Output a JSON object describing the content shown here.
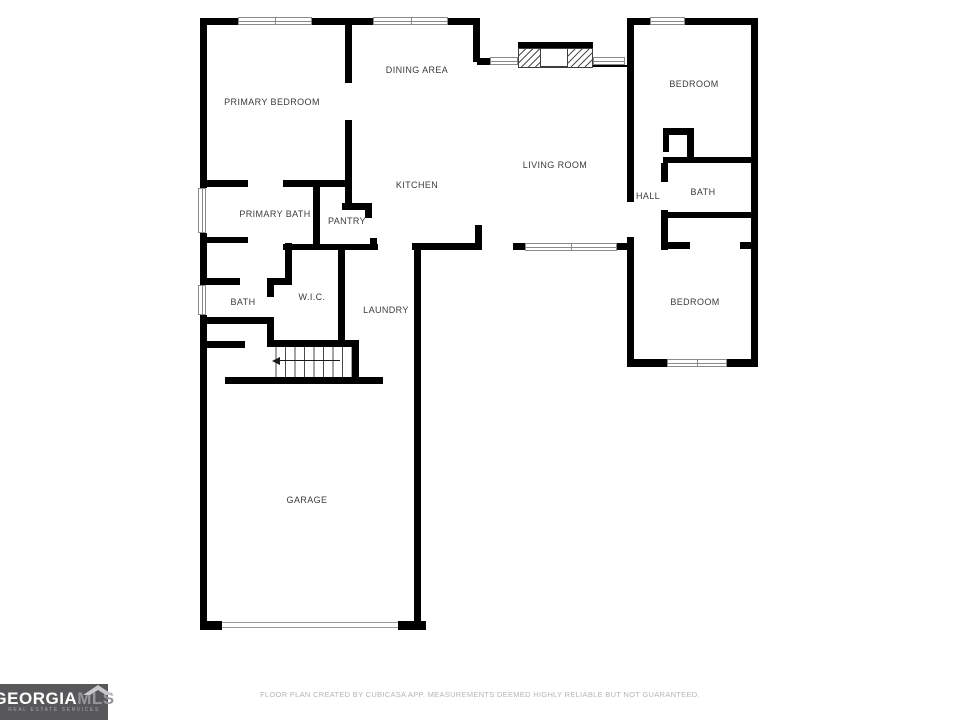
{
  "footer": {
    "disclaimer": "FLOOR PLAN CREATED BY CUBICASA APP. MEASUREMENTS DEEMED HIGHLY RELIABLE BUT NOT GUARANTEED."
  },
  "logo": {
    "brand_part1": "GEORGIA",
    "brand_part2": "MLS",
    "tagline": "REAL ESTATE SERVICES"
  },
  "floorplan": {
    "colors": {
      "wall": "#000000",
      "window_line": "#8a8a8a",
      "label": "#3b3b3b",
      "footer_text": "#b5b5b5",
      "logo_bg": "#58585a"
    },
    "rooms": [
      {
        "id": "primary-bedroom",
        "label": "PRIMARY BEDROOM",
        "cx": 272,
        "cy": 102
      },
      {
        "id": "dining-area",
        "label": "DINING AREA",
        "cx": 417,
        "cy": 70
      },
      {
        "id": "bedroom-top",
        "label": "BEDROOM",
        "cx": 694,
        "cy": 84
      },
      {
        "id": "living-room",
        "label": "LIVING ROOM",
        "cx": 555,
        "cy": 165
      },
      {
        "id": "kitchen",
        "label": "KITCHEN",
        "cx": 417,
        "cy": 185
      },
      {
        "id": "hall",
        "label": "HALL",
        "cx": 648,
        "cy": 196
      },
      {
        "id": "bath-right",
        "label": "BATH",
        "cx": 703,
        "cy": 192
      },
      {
        "id": "primary-bath",
        "label": "PRIMARY BATH",
        "cx": 275,
        "cy": 214
      },
      {
        "id": "pantry",
        "label": "PANTRY",
        "cx": 347,
        "cy": 221
      },
      {
        "id": "bath-left",
        "label": "BATH",
        "cx": 243,
        "cy": 302
      },
      {
        "id": "wic",
        "label": "W.I.C.",
        "cx": 312,
        "cy": 297
      },
      {
        "id": "laundry",
        "label": "LAUNDRY",
        "cx": 386,
        "cy": 310
      },
      {
        "id": "bedroom-bottom",
        "label": "BEDROOM",
        "cx": 695,
        "cy": 302
      },
      {
        "id": "garage",
        "label": "GARAGE",
        "cx": 307,
        "cy": 500
      }
    ],
    "walls": [
      [
        200,
        18,
        7,
        170
      ],
      [
        200,
        233,
        7,
        52
      ],
      [
        200,
        315,
        7,
        315
      ],
      [
        200,
        18,
        38,
        7
      ],
      [
        312,
        18,
        61,
        7
      ],
      [
        448,
        18,
        32,
        7
      ],
      [
        473,
        18,
        7,
        44
      ],
      [
        477,
        58,
        13,
        7
      ],
      [
        593,
        65,
        34,
        2
      ],
      [
        627,
        18,
        23,
        7
      ],
      [
        685,
        18,
        73,
        7
      ],
      [
        751,
        18,
        7,
        349
      ],
      [
        345,
        25,
        7,
        58
      ],
      [
        345,
        120,
        7,
        83
      ],
      [
        200,
        180,
        48,
        7
      ],
      [
        283,
        180,
        69,
        7
      ],
      [
        313,
        187,
        7,
        63
      ],
      [
        342,
        203,
        30,
        7
      ],
      [
        365,
        210,
        7,
        8
      ],
      [
        370,
        238,
        7,
        9
      ],
      [
        200,
        237,
        48,
        6
      ],
      [
        285,
        243,
        7,
        39
      ],
      [
        203,
        278,
        37,
        7
      ],
      [
        267,
        278,
        25,
        7
      ],
      [
        267,
        285,
        7,
        12
      ],
      [
        267,
        322,
        7,
        23
      ],
      [
        200,
        317,
        74,
        7
      ],
      [
        200,
        341,
        45,
        7
      ],
      [
        283,
        244,
        95,
        6
      ],
      [
        338,
        244,
        7,
        96
      ],
      [
        267,
        340,
        91,
        7
      ],
      [
        352,
        340,
        7,
        44
      ],
      [
        225,
        377,
        158,
        7
      ],
      [
        412,
        243,
        70,
        7
      ],
      [
        475,
        225,
        7,
        18
      ],
      [
        513,
        243,
        12,
        7
      ],
      [
        617,
        243,
        16,
        7
      ],
      [
        414,
        243,
        7,
        387
      ],
      [
        200,
        621,
        22,
        9
      ],
      [
        398,
        621,
        28,
        9
      ],
      [
        627,
        18,
        7,
        184
      ],
      [
        627,
        237,
        7,
        130
      ],
      [
        663,
        128,
        29,
        7
      ],
      [
        663,
        130,
        6,
        22
      ],
      [
        687,
        128,
        7,
        35
      ],
      [
        663,
        157,
        95,
        6
      ],
      [
        661,
        163,
        7,
        19
      ],
      [
        661,
        210,
        7,
        40
      ],
      [
        661,
        212,
        97,
        6
      ],
      [
        663,
        242,
        27,
        7
      ],
      [
        740,
        242,
        18,
        7
      ],
      [
        627,
        359,
        40,
        8
      ],
      [
        727,
        359,
        31,
        8
      ]
    ],
    "windows": [
      {
        "x": 238,
        "y": 17,
        "w": 74,
        "h": 8,
        "dir": "h",
        "dividers": [
          0.5
        ]
      },
      {
        "x": 373,
        "y": 17,
        "w": 75,
        "h": 8,
        "dir": "h",
        "dividers": [
          0.5
        ]
      },
      {
        "x": 650,
        "y": 17,
        "w": 35,
        "h": 8,
        "dir": "h",
        "dividers": []
      },
      {
        "x": 490,
        "y": 57,
        "w": 28,
        "h": 8,
        "dir": "h",
        "dividers": []
      },
      {
        "x": 593,
        "y": 57,
        "w": 32,
        "h": 8,
        "dir": "h",
        "dividers": []
      },
      {
        "x": 198,
        "y": 188,
        "w": 8,
        "h": 45,
        "dir": "v",
        "dividers": []
      },
      {
        "x": 198,
        "y": 285,
        "w": 8,
        "h": 30,
        "dir": "v",
        "dividers": []
      },
      {
        "x": 525,
        "y": 243,
        "w": 92,
        "h": 8,
        "dir": "h",
        "dividers": [
          0.5
        ]
      },
      {
        "x": 667,
        "y": 359,
        "w": 60,
        "h": 8,
        "dir": "h",
        "dividers": [
          0.5
        ]
      }
    ],
    "stairs": {
      "x": 267,
      "y": 347,
      "w": 85,
      "h": 30,
      "arrow": {
        "x1": 276,
        "x2": 340,
        "y": 360
      }
    },
    "fireplace": {
      "x": 518,
      "y": 42,
      "w": 75,
      "h": 26,
      "firebox": {
        "x": 22,
        "y": 6,
        "w": 28,
        "h": 19
      }
    },
    "garage_door": {
      "x": 222,
      "y": 622,
      "w": 176
    }
  }
}
